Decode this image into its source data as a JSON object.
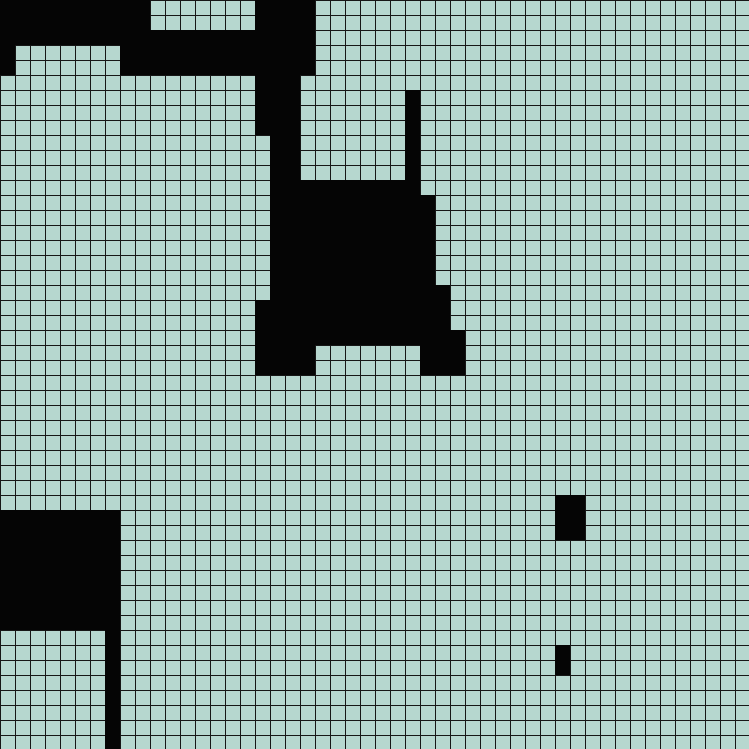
{
  "app": {
    "name": "grid-world-view",
    "description": "50x50 tile grid with light teal open tiles and solid black filled tiles"
  },
  "grid": {
    "rows": 50,
    "cols": 50,
    "cell_px": 15,
    "viewport_px": 749,
    "colors": {
      "cell": "#b6d7cf",
      "line": "#161616",
      "filled": "#050505"
    },
    "filled_runs": [
      [
        0,
        0,
        9
      ],
      [
        0,
        17,
        20
      ],
      [
        1,
        0,
        9
      ],
      [
        1,
        17,
        20
      ],
      [
        2,
        0,
        20
      ],
      [
        3,
        0,
        0
      ],
      [
        3,
        8,
        20
      ],
      [
        4,
        0,
        0
      ],
      [
        4,
        8,
        20
      ],
      [
        5,
        17,
        19
      ],
      [
        6,
        17,
        19
      ],
      [
        6,
        27,
        27
      ],
      [
        7,
        17,
        19
      ],
      [
        7,
        27,
        27
      ],
      [
        8,
        17,
        19
      ],
      [
        8,
        27,
        27
      ],
      [
        9,
        18,
        19
      ],
      [
        9,
        27,
        27
      ],
      [
        10,
        18,
        19
      ],
      [
        10,
        27,
        27
      ],
      [
        11,
        18,
        19
      ],
      [
        11,
        27,
        27
      ],
      [
        12,
        18,
        27
      ],
      [
        13,
        18,
        28
      ],
      [
        14,
        18,
        28
      ],
      [
        15,
        18,
        28
      ],
      [
        16,
        18,
        28
      ],
      [
        17,
        18,
        28
      ],
      [
        18,
        18,
        28
      ],
      [
        19,
        18,
        29
      ],
      [
        20,
        17,
        29
      ],
      [
        21,
        17,
        29
      ],
      [
        22,
        17,
        30
      ],
      [
        23,
        17,
        20
      ],
      [
        23,
        28,
        30
      ],
      [
        24,
        17,
        20
      ],
      [
        24,
        28,
        30
      ],
      [
        33,
        37,
        38
      ],
      [
        34,
        0,
        7
      ],
      [
        34,
        37,
        38
      ],
      [
        35,
        0,
        7
      ],
      [
        35,
        37,
        38
      ],
      [
        36,
        0,
        7
      ],
      [
        37,
        0,
        7
      ],
      [
        38,
        0,
        7
      ],
      [
        39,
        0,
        7
      ],
      [
        40,
        0,
        7
      ],
      [
        41,
        0,
        7
      ],
      [
        42,
        7,
        7
      ],
      [
        43,
        7,
        7
      ],
      [
        43,
        37,
        37
      ],
      [
        44,
        7,
        7
      ],
      [
        44,
        37,
        37
      ],
      [
        45,
        7,
        7
      ],
      [
        46,
        7,
        7
      ],
      [
        47,
        7,
        7
      ],
      [
        48,
        7,
        7
      ],
      [
        49,
        7,
        7
      ]
    ]
  }
}
